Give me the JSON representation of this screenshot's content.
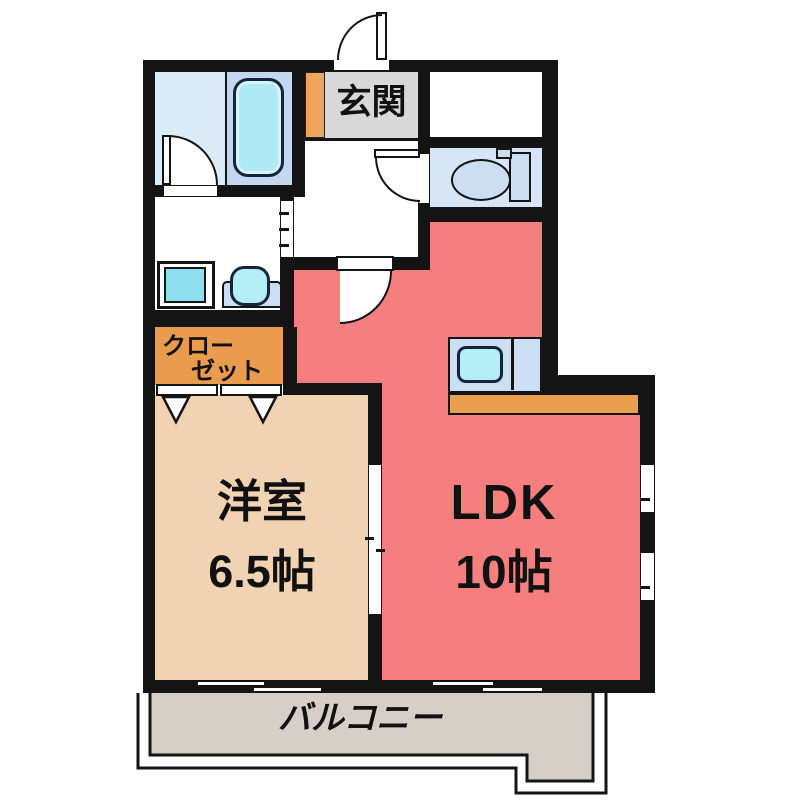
{
  "floor_plan": {
    "background_color": "#ffffff",
    "wall_color": "#141414",
    "rooms": {
      "genkan": {
        "label": "玄関",
        "floor_color": "#d8d8d8",
        "step_color": "#eda55e"
      },
      "storage": {
        "floor_color": "#ffffff"
      },
      "bathroom": {
        "floor_color": "#dcebf8",
        "tub_deck_color": "#c2d8f0",
        "tub_color": "#b0eaf4"
      },
      "washroom": {
        "floor_color": "#ffffff",
        "washer_color": "#8ee0ee"
      },
      "toilet": {
        "floor_color": "#d6e6f6",
        "fixture_color": "#ccdff2"
      },
      "closet": {
        "label_line1": "クロー",
        "label_line2": "ゼット",
        "floor_color": "#e99c4e"
      },
      "western_room": {
        "label": "洋室",
        "size_label": "6.5帖",
        "floor_color": "#f0d3b3"
      },
      "ldk": {
        "label": "LDK",
        "size_label": "10帖",
        "floor_color": "#f57f7f"
      },
      "kitchen": {
        "counter_color": "#e9a04e",
        "unit_color": "#ccdff2",
        "sink_color": "#b5eef6"
      },
      "balcony": {
        "label": "バルコニー",
        "floor_color": "#d6cfc8"
      }
    },
    "icons": [
      "bathtub-icon",
      "washing-machine-icon",
      "washbasin-icon",
      "toilet-icon",
      "kitchen-sink-icon",
      "door-swing-arc-icon",
      "sliding-window-icon",
      "folding-door-triangle-icon"
    ]
  }
}
